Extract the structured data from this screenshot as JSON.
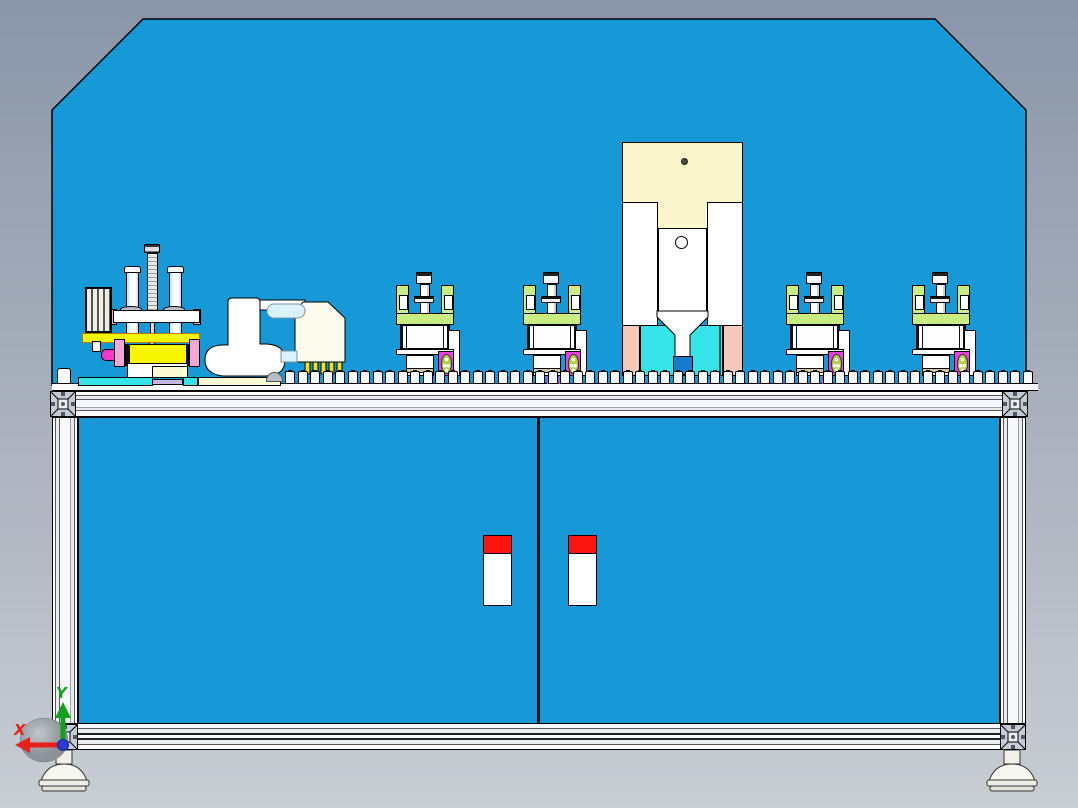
{
  "axis_triad": {
    "x_label": "X",
    "y_label": "Y"
  },
  "palette": {
    "background_top": "#8a96a8",
    "background_bottom": "#c9cdd4",
    "panel_blue": "#1699d6",
    "frame_white": "#f6f7fa",
    "cream": "#fbf6cb",
    "pale_yellow": "#fdfad6",
    "cyan": "#35e4e8",
    "salmon": "#f6c8b9",
    "magenta": "#e640dd",
    "bright_pink": "#f537c8",
    "pink": "#f4a6d4",
    "lavender": "#c9b6e4",
    "yellow": "#f6f600",
    "light_green": "#c8ee82",
    "tan": "#cfc89a",
    "handle_red": "#fa1511",
    "inner_blue": "#1879cb",
    "light_blue": "#daf2fa",
    "axis_red": "#e6211a",
    "axis_green": "#13a01f",
    "axis_blue": "#2b3bd4"
  },
  "machine": {
    "stations": [
      {
        "name": "press-station-1",
        "x": 396,
        "fringe": false
      },
      {
        "name": "press-station-2",
        "x": 523,
        "fringe": true
      },
      {
        "name": "press-station-3",
        "x": 786,
        "fringe": true
      },
      {
        "name": "press-station-4",
        "x": 912,
        "fringe": true
      }
    ],
    "conveyor": {
      "block_count": 60,
      "start_x": 285,
      "pitch": 12.5
    },
    "doors": {
      "count": 2
    }
  }
}
